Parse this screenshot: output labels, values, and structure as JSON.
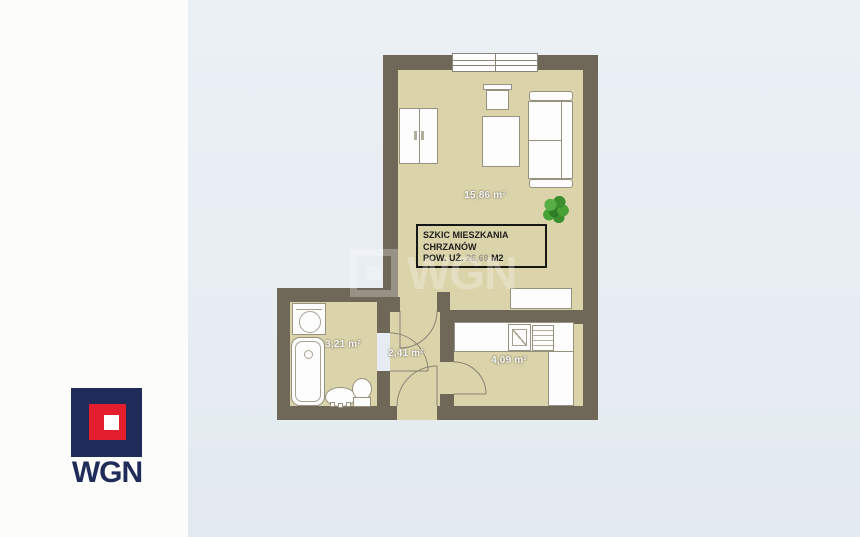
{
  "page": {
    "background_color": "#e7edf2",
    "left_panel_color": "#fcfcfb"
  },
  "watermark": {
    "text": "WGN"
  },
  "logo": {
    "text": "WGN",
    "navy_color": "#1f2c59",
    "red_color": "#e41e2d"
  },
  "floorplan": {
    "colors": {
      "wall": "#6f6757",
      "floor": "#dbd3a9",
      "furniture_fill": "#fdfdfd",
      "furniture_border": "#97917f",
      "plant_green": "#3c8f2e"
    },
    "info_box": {
      "title_line1": "SZKIC MIESZKANIA",
      "title_line2": "CHRZANÓW",
      "area_label": "POW. UŻ.",
      "area_value": "26,69",
      "area_unit": "M2"
    },
    "rooms": {
      "living_room": {
        "area": "15,86 m²"
      },
      "bathroom": {
        "area": "3,21 m²"
      },
      "hallway": {
        "area": "2,41 m²"
      },
      "kitchen": {
        "area": "4,09 m²"
      }
    }
  }
}
